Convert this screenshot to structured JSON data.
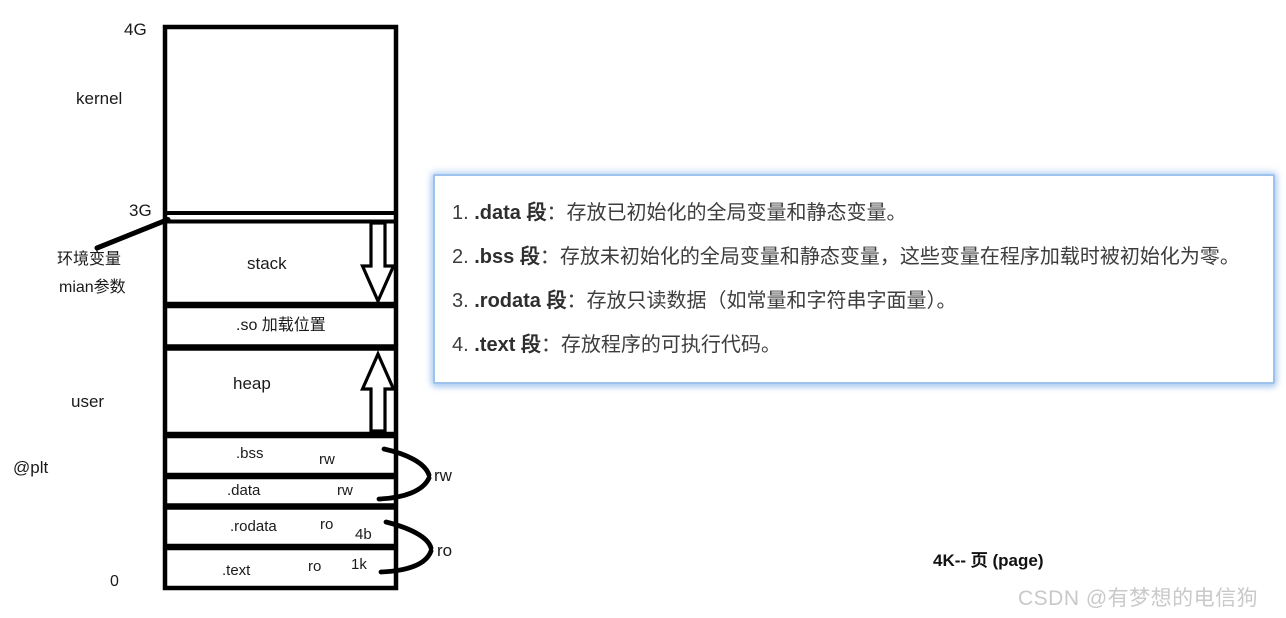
{
  "diagram": {
    "labels": {
      "four_g": "4G",
      "kernel": "kernel",
      "three_g": "3G",
      "env_var": "环境变量",
      "main_args": "mian参数",
      "user": "user",
      "plt": "@plt",
      "zero": "0"
    },
    "sections": {
      "stack": "stack",
      "so": ".so 加载位置",
      "heap": "heap",
      "bss": ".bss",
      "bss_perm": "rw",
      "data": ".data",
      "data_perm": "rw",
      "rodata": ".rodata",
      "rodata_perm": "ro",
      "rodata_size": "4b",
      "text": ".text",
      "text_perm": "ro",
      "text_size": "1k"
    },
    "group_labels": {
      "rw": "rw",
      "ro": "ro"
    }
  },
  "notes": {
    "items": [
      {
        "num": "1.",
        "name": ".data 段",
        "desc": "：存放已初始化的全局变量和静态变量。"
      },
      {
        "num": "2.",
        "name": ".bss 段",
        "desc": "：存放未初始化的全局变量和静态变量，这些变量在程序加载时被初始化为零。"
      },
      {
        "num": "3.",
        "name": ".rodata 段",
        "desc": "：存放只读数据（如常量和字符串字面量）。"
      },
      {
        "num": "4.",
        "name": ".text 段",
        "desc": "：存放程序的可执行代码。"
      }
    ]
  },
  "footer": {
    "page_note": "4K-- 页 (page)",
    "watermark": "CSDN @有梦想的电信狗"
  },
  "colors": {
    "line": "#000000",
    "note_border": "#9dc3ec",
    "note_text": "#3d3d3d",
    "watermark": "#c9c9c9",
    "background": "#ffffff"
  }
}
